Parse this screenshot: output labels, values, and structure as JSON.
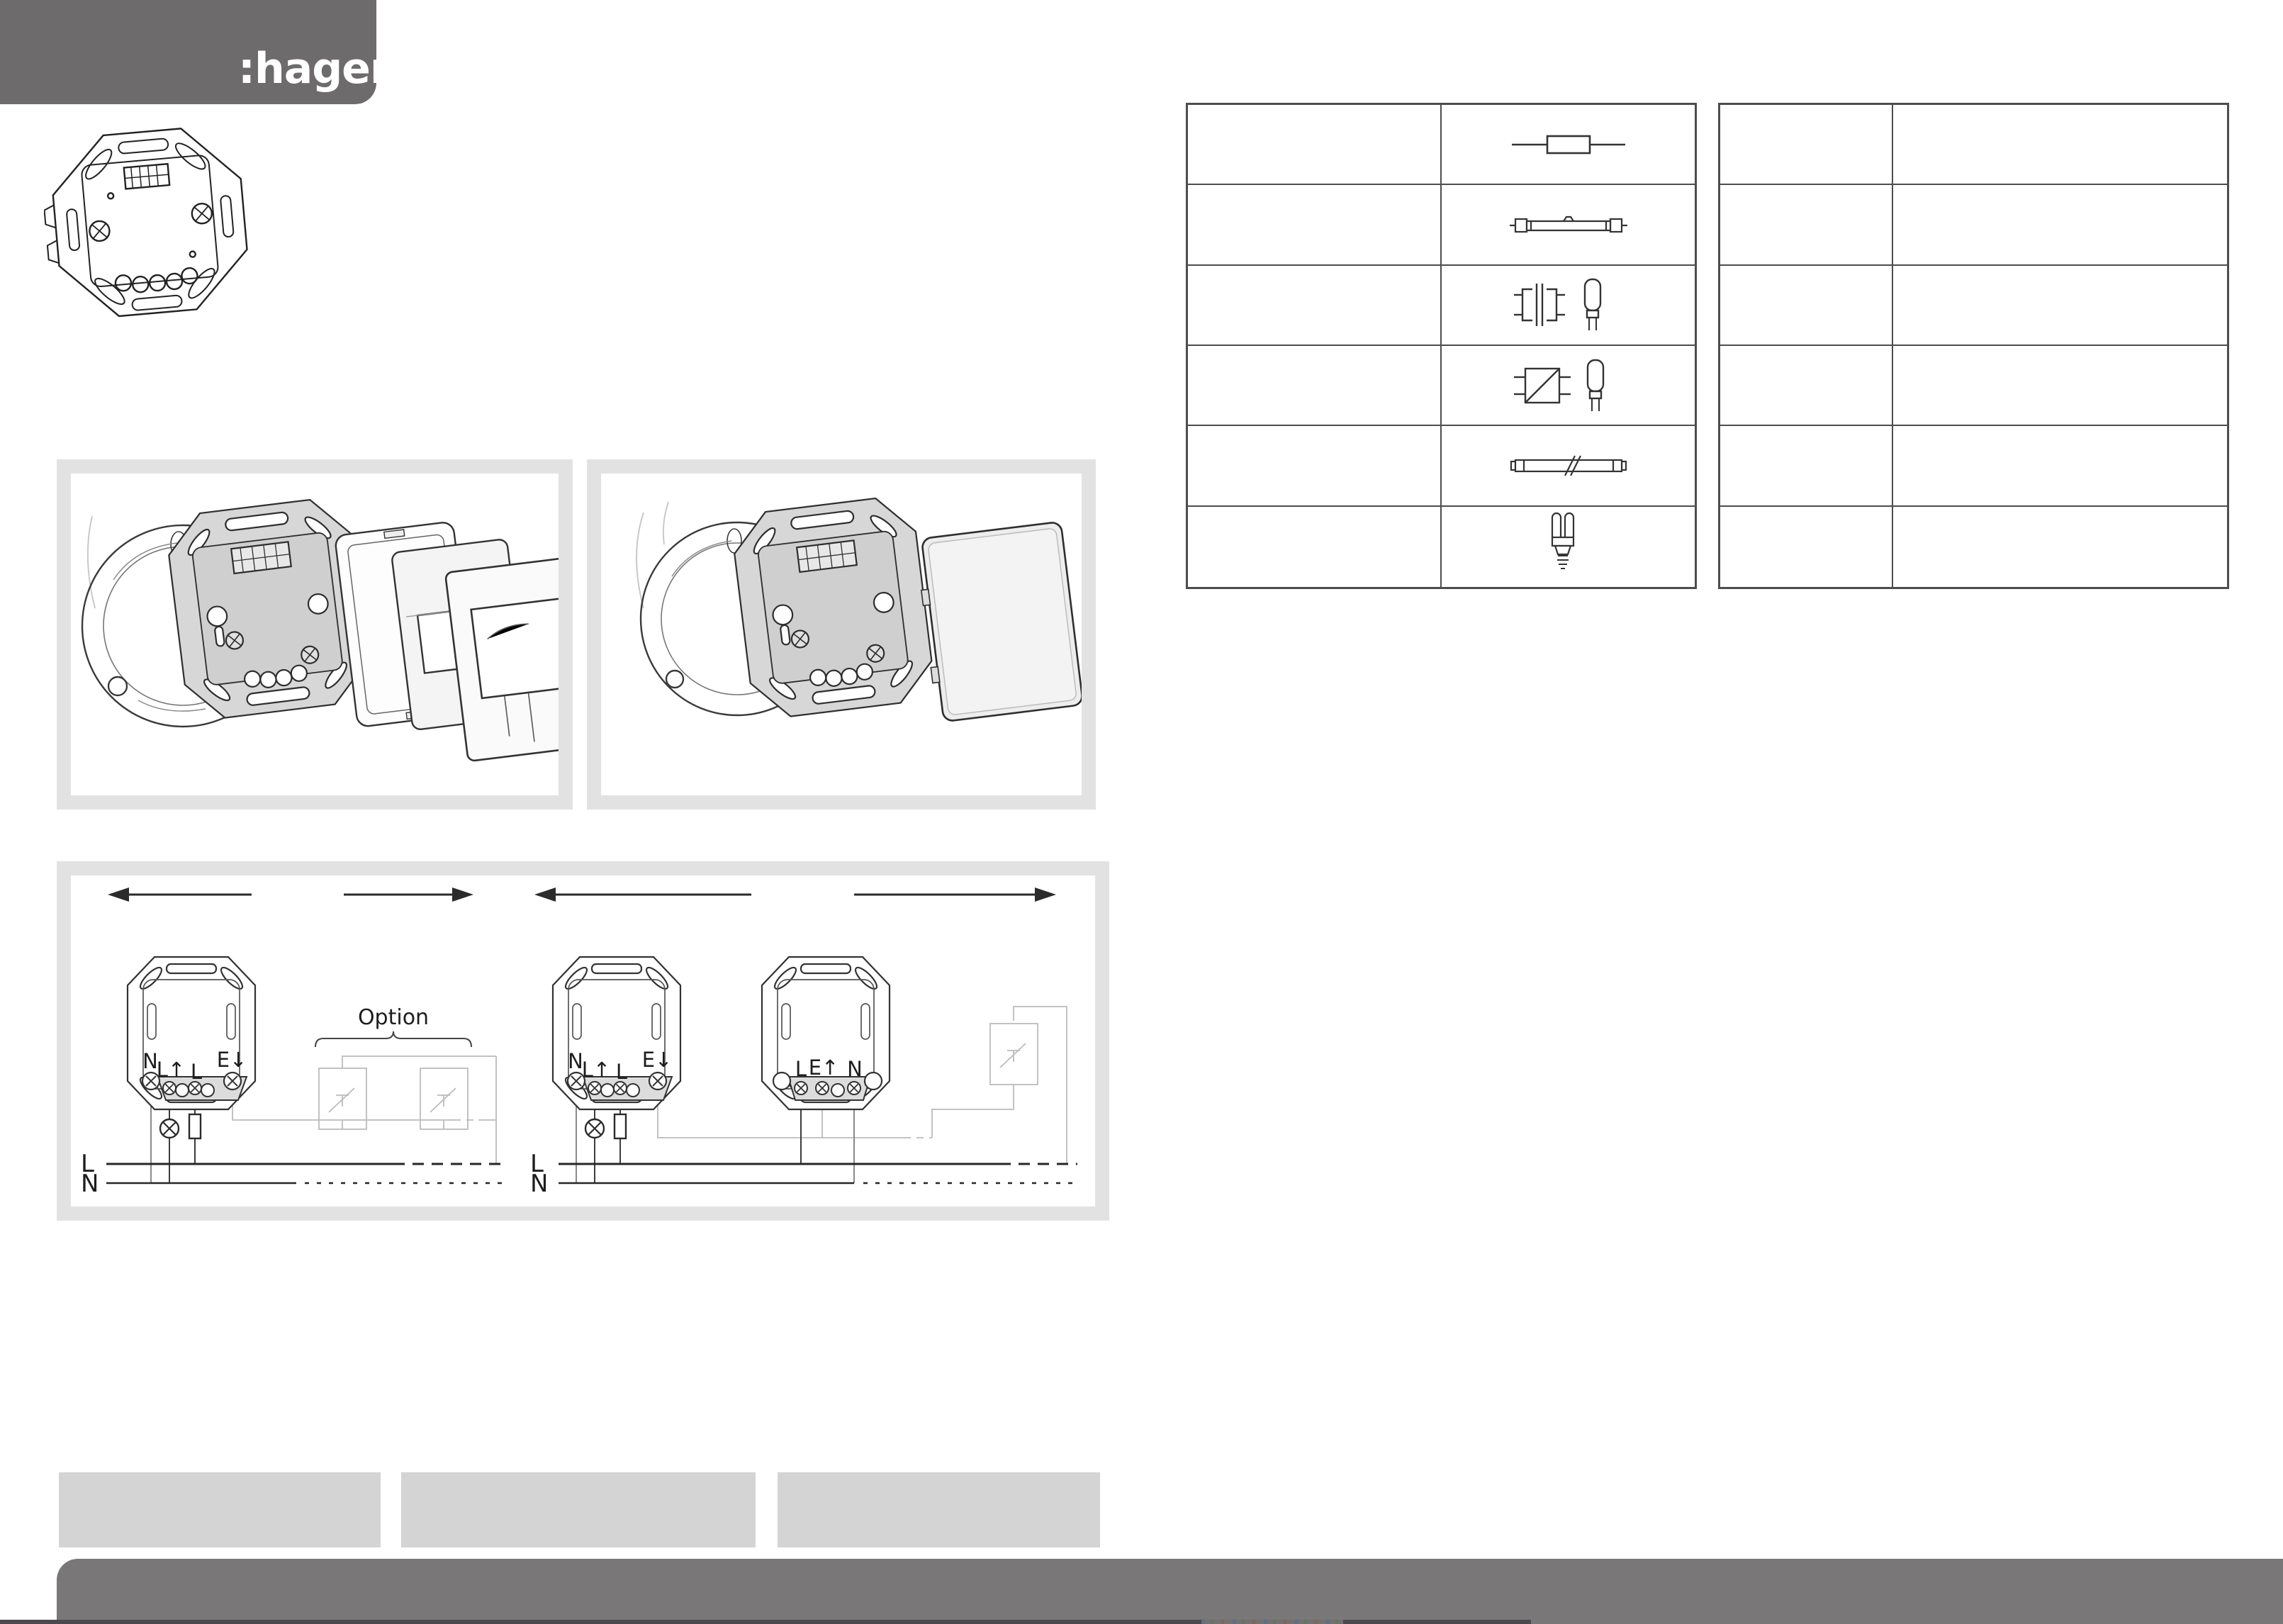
{
  "brand": {
    "logo_text": ":hager"
  },
  "colors": {
    "header_gray": "#6e6b6c",
    "footer_gray": "#7a7778",
    "bottom_strip": "#4b494b",
    "placeholder_box_gray": "#d4d4d4",
    "panel_border_gray": "#e3e2e2",
    "table_line": "#4d4d4d",
    "line_art_dark": "#333333",
    "line_art_light": "#bbbbbb",
    "terminal_strip_gray": "#dcdcdc"
  },
  "lamp_table": {
    "left_table_rows": [
      {
        "load_cell": "",
        "icon": "incandescent-lamp-icon"
      },
      {
        "load_cell": "",
        "icon": "halogen-lamp-230v-icon"
      },
      {
        "load_cell": "",
        "icon": "conventional-transformer-halogen-icon"
      },
      {
        "load_cell": "",
        "icon": "electronic-transformer-halogen-icon"
      },
      {
        "load_cell": "",
        "icon": "fluorescent-tube-icon"
      },
      {
        "load_cell": "",
        "icon": "cfl-lamp-icon"
      }
    ],
    "right_table_rows": [
      {
        "col1": "",
        "col2": ""
      },
      {
        "col1": "",
        "col2": ""
      },
      {
        "col1": "",
        "col2": ""
      },
      {
        "col1": "",
        "col2": ""
      },
      {
        "col1": "",
        "col2": ""
      },
      {
        "col1": "",
        "col2": ""
      }
    ]
  },
  "wiring": {
    "option_label": "Option",
    "bus": [
      "L",
      "N"
    ],
    "diagram1": {
      "terminals": [
        "N",
        "L↑",
        "L",
        "E↓"
      ]
    },
    "diagram2": {
      "main_terminals": [
        "N",
        "L↑",
        "L",
        "E↓"
      ],
      "ext_terminals": [
        "L",
        "E↑",
        "N"
      ]
    }
  }
}
